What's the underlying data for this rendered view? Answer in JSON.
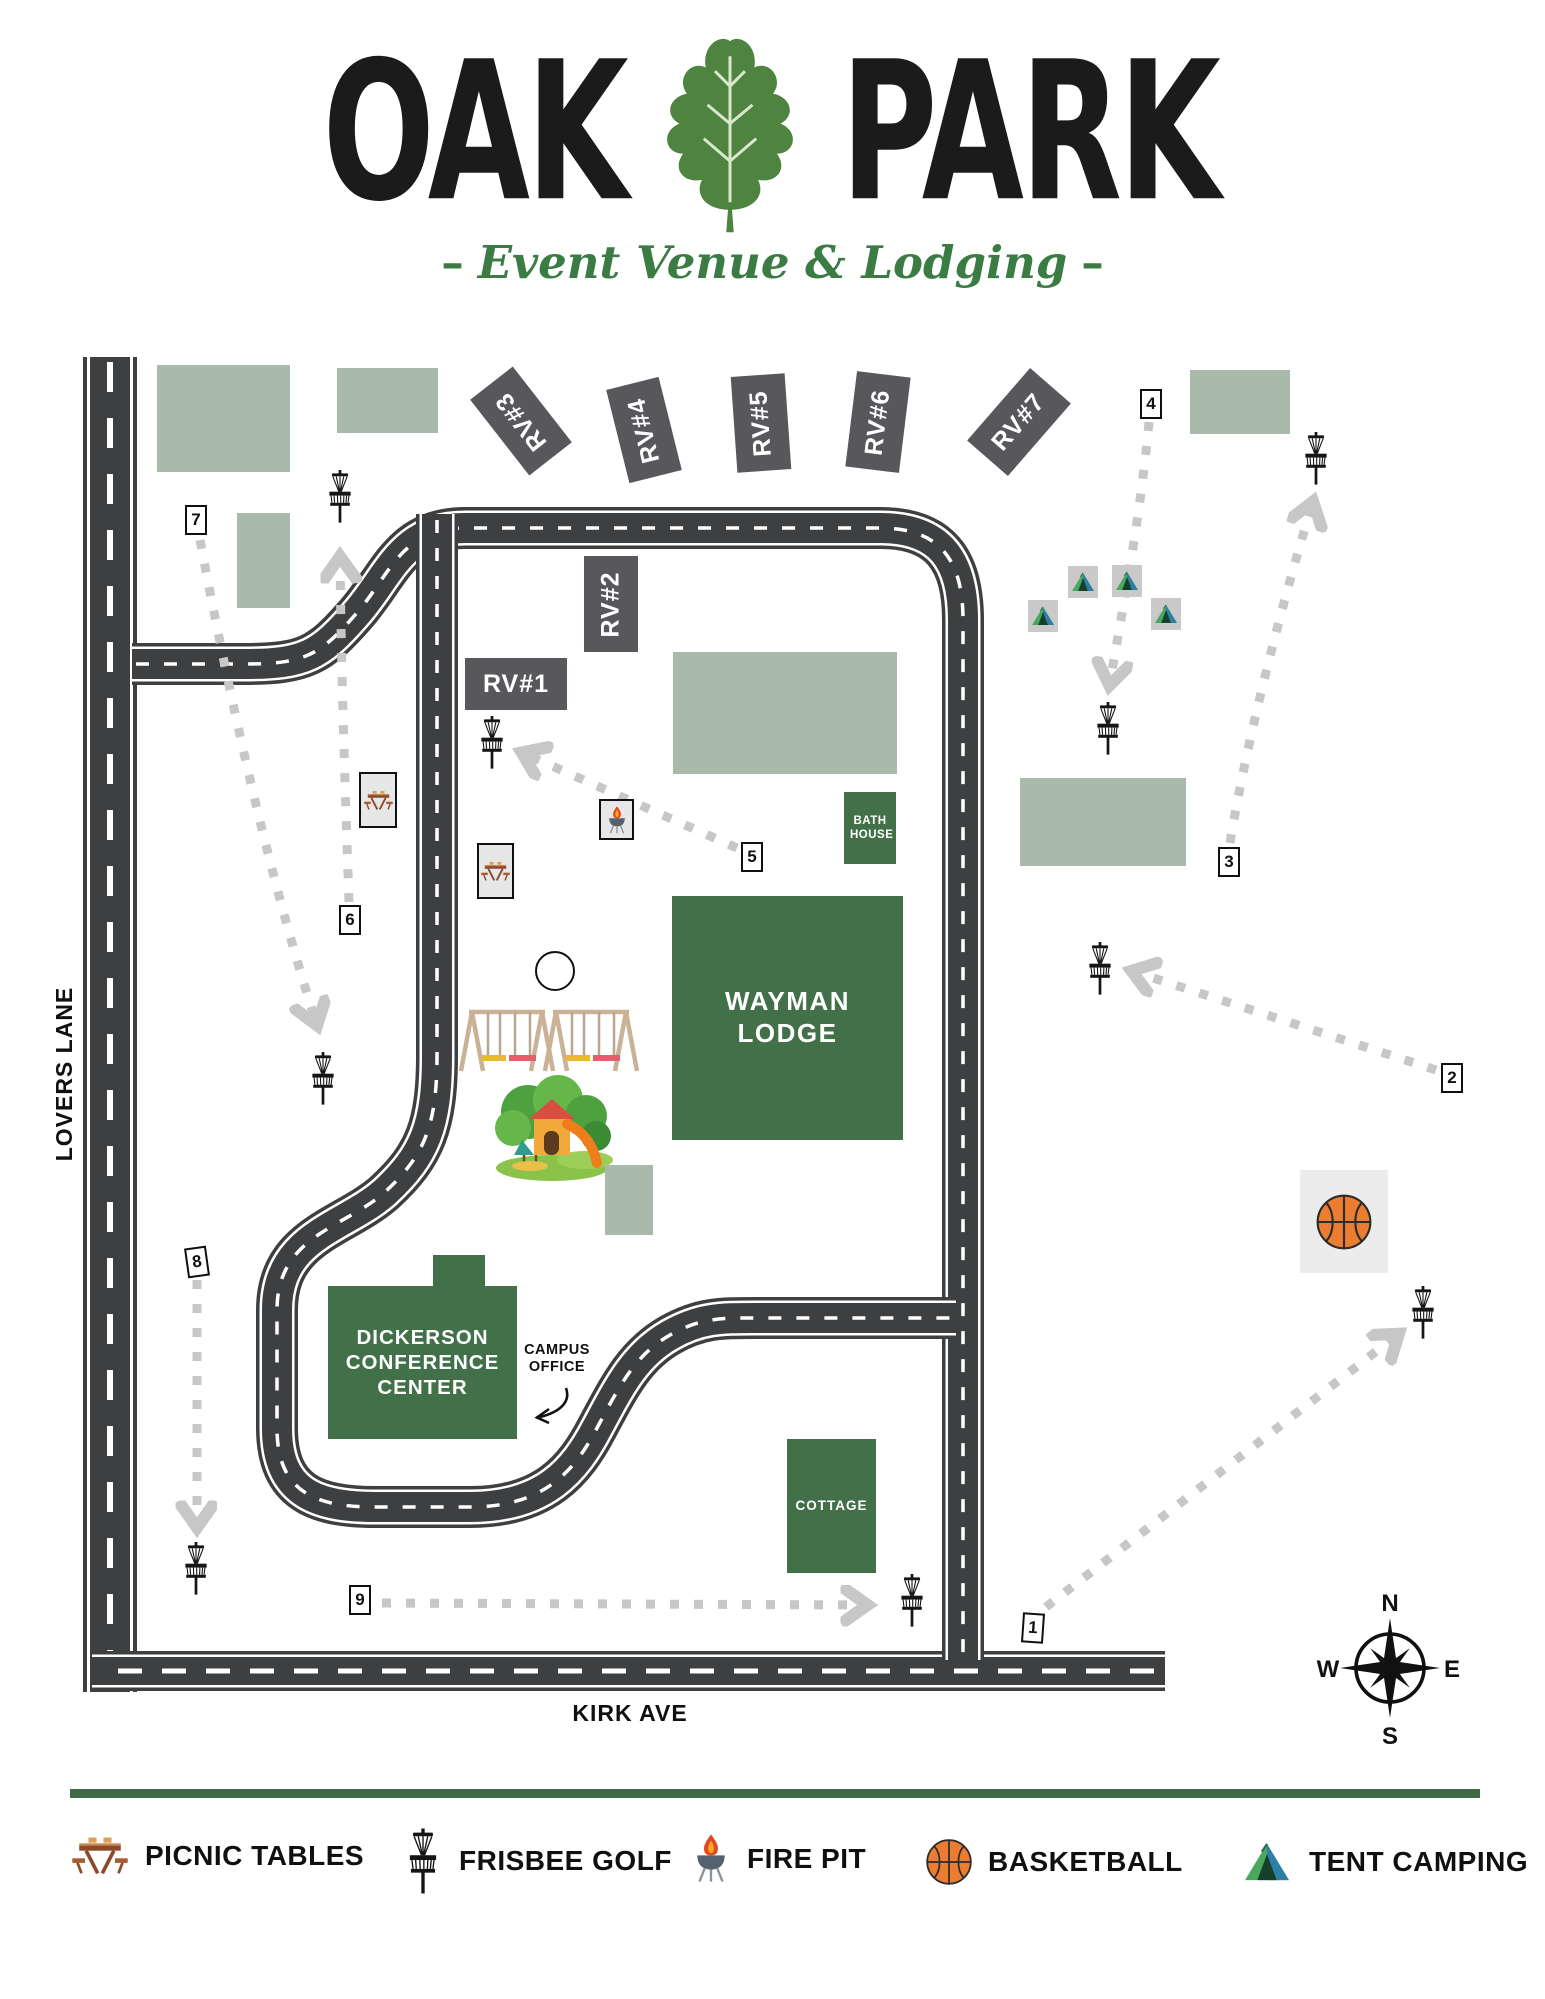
{
  "title": {
    "word_left": "OAK",
    "word_right": "PARK",
    "subtitle": "Event Venue & Lodging",
    "dash": "–"
  },
  "streets": {
    "left": "LOVERS LANE",
    "bottom": "KIRK AVE"
  },
  "buildings": {
    "wayman": "WAYMAN LODGE",
    "bath_house": "BATH HOUSE",
    "dickerson": "DICKERSON CONFERENCE CENTER",
    "cottage": "COTTAGE",
    "campus_office": "CAMPUS OFFICE"
  },
  "rv_spots": [
    "RV#1",
    "RV#2",
    "RV#3",
    "RV#4",
    "RV#5",
    "RV#6",
    "RV#7"
  ],
  "disc_golf_tees": [
    "1",
    "2",
    "3",
    "4",
    "5",
    "6",
    "7",
    "8",
    "9"
  ],
  "legend": {
    "items": [
      {
        "icon": "picnic-table-icon",
        "label": "PICNIC TABLES"
      },
      {
        "icon": "disc-golf-basket-icon",
        "label": "FRISBEE GOLF"
      },
      {
        "icon": "fire-pit-icon",
        "label": "FIRE PIT"
      },
      {
        "icon": "basketball-icon",
        "label": "BASKETBALL"
      },
      {
        "icon": "tent-icon",
        "label": "TENT CAMPING"
      }
    ]
  },
  "compass": {
    "n": "N",
    "e": "E",
    "s": "S",
    "w": "W"
  },
  "colors": {
    "building_green": "#417049",
    "pad_sage": "#a9baaa",
    "road_dark": "#3e3f41",
    "rv_gray": "#58585c",
    "path_dot_gray": "#c7c7c7",
    "accent_green_bar": "#3e6b46",
    "leaf_green": "#4e8340",
    "subtitle_green": "#3a7c44",
    "basketball_orange": "#ec7c30"
  }
}
